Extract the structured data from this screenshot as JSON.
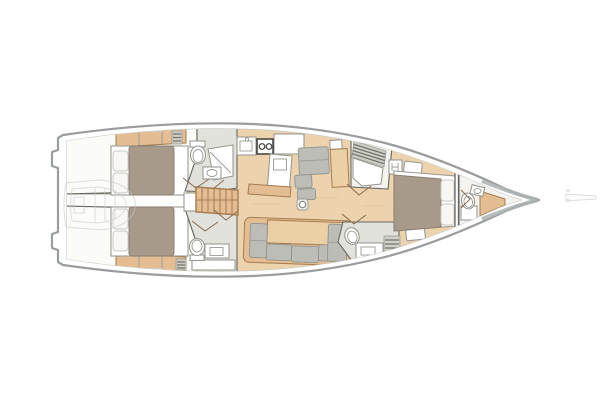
{
  "meta": {
    "title": "Sailing yacht interior layout plan, top-down view, bow pointing right",
    "orientation": "bow-right",
    "diagram_type": "boat-floor-plan"
  },
  "colors": {
    "paper": "#ffffff",
    "hull-line": "#9a9d9e",
    "hull-band": "#aeb1b1",
    "hull-inner-line": "#c4c6c6",
    "wall-line": "#67675f",
    "wood-floor": "#ecd3ae",
    "wood-grain": "#dfbf94",
    "wood-furniture": "#e4bd92",
    "table-wood": "#ead0a4",
    "wood-dark": "#a57c50",
    "cabin-floor": "#fbfbf8",
    "head-floor": "#e2e2dd",
    "bow-floor": "#f4f3ef",
    "fixture-white": "#ffffff",
    "fixture-line": "#9a9a93",
    "cushion-gray": "#bcbdb7",
    "cushion-edge": "#93948e",
    "duvet": "#a89a8b",
    "duvet-edge": "#8d8073",
    "linen-white": "#f8f7f4",
    "grate-bg": "#cfcfc9",
    "grate-dark": "#75756d",
    "stove-dark": "#3d3d3a",
    "door-line": "#8a6a4c",
    "ghost-line": "#c9c9c9"
  },
  "rooms": [
    {
      "id": "swim-platform",
      "label": "Fold-down transom platform"
    },
    {
      "id": "tender-garage",
      "label": "Tender garage with dinghy stowage"
    },
    {
      "id": "aft-cabin-port",
      "label": "Aft double cabin (top)",
      "features": [
        "double-bed",
        "pillows",
        "lockers",
        "hull-window",
        "vent-grille"
      ]
    },
    {
      "id": "aft-cabin-starboard",
      "label": "Aft double cabin (bottom)",
      "features": [
        "double-bed",
        "pillows",
        "lockers",
        "hull-window",
        "vent-grille"
      ]
    },
    {
      "id": "aft-head-port",
      "label": "Aft head (top)",
      "features": [
        "toilet",
        "shower-pan",
        "washbasin"
      ]
    },
    {
      "id": "aft-head-starboard",
      "label": "Aft head (bottom)",
      "features": [
        "toilet",
        "washbasin",
        "cabinet",
        "vent-grille"
      ]
    },
    {
      "id": "companionway",
      "label": "Companionway steps"
    },
    {
      "id": "galley",
      "label": "Galley",
      "features": [
        "sink",
        "two-burner-stove",
        "counter",
        "island-unit",
        "bench"
      ]
    },
    {
      "id": "nav-settee",
      "label": "Chart table and settee",
      "features": [
        "table",
        "bench-cushions",
        "ottoman",
        "locker"
      ]
    },
    {
      "id": "saloon",
      "label": "Saloon",
      "features": [
        "u-shaped-sofa",
        "table",
        "mast-step"
      ]
    },
    {
      "id": "forward-shower",
      "label": "Forward shower room",
      "features": [
        "shower-grate",
        "shower-pan"
      ]
    },
    {
      "id": "forward-head",
      "label": "Forward head",
      "features": [
        "toilet",
        "washbasin-counter",
        "vent-grille"
      ]
    },
    {
      "id": "owner-cabin",
      "label": "Owner's cabin forward",
      "features": [
        "island-double-bed",
        "pillows",
        "hanging-locker",
        "side-benches"
      ]
    },
    {
      "id": "bow-head",
      "label": "Bow crew head",
      "features": [
        "toilet",
        "washbasin",
        "seat",
        "cabinet"
      ]
    },
    {
      "id": "bowsprit",
      "label": "Bowsprit"
    }
  ]
}
